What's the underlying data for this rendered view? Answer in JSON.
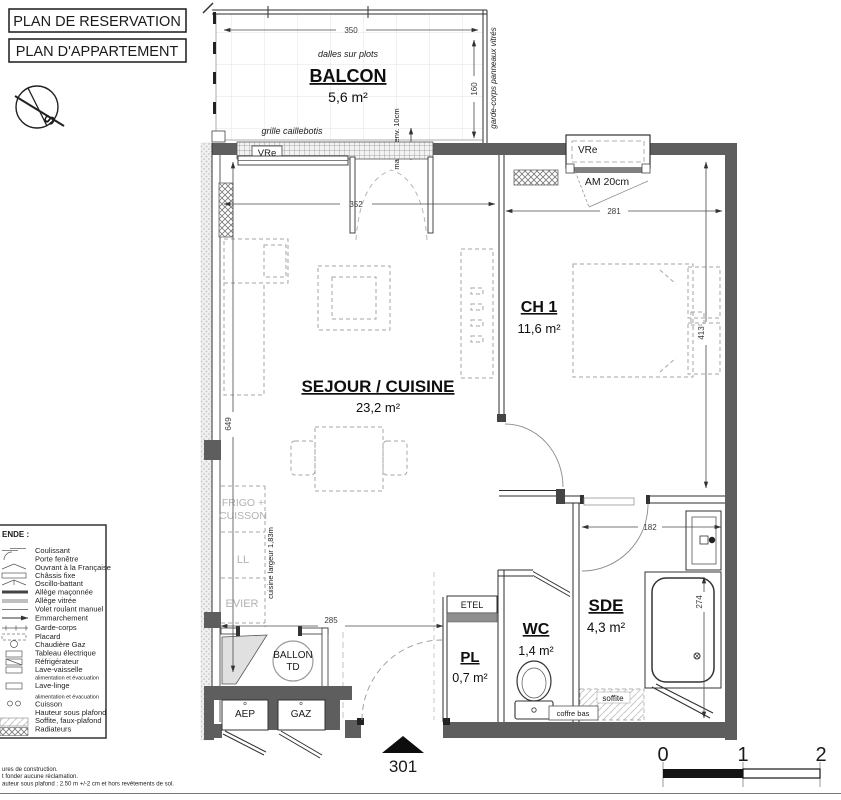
{
  "header": {
    "line1": "PLAN DE RESERVATION",
    "line2": "PLAN D'APPARTEMENT",
    "compass": "S"
  },
  "balcony": {
    "label": "BALCON",
    "area": "5,6 m²",
    "floor_note": "dalles sur plots",
    "grille_note": "grille caillebotis",
    "railing_note": "garde-corps panneaux vitrés",
    "step_note": "marche env. 10cm",
    "window": "VRe"
  },
  "rooms": {
    "sejour": {
      "label": "SEJOUR / CUISINE",
      "area": "23,2 m²"
    },
    "ch1": {
      "label": "CH 1",
      "area": "11,6 m²"
    },
    "wc": {
      "label": "WC",
      "area": "1,4 m²"
    },
    "pl": {
      "label": "PL",
      "area": "0,7 m²"
    },
    "sde": {
      "label": "SDE",
      "area": "4,3 m²"
    }
  },
  "labels": {
    "vre_ch1": "VRe",
    "am": "AM 20cm",
    "etel": "ETEL",
    "ballon_line1": "BALLON",
    "ballon_line2": "TD",
    "aep": "AEP",
    "gaz": "GAZ",
    "frigo_line1": "FRIGO +",
    "frigo_line2": "CUISSON",
    "ll": "LL",
    "evier": "EVIER",
    "kitchen_width": "cuisine largeur 1,83m",
    "soffite": "soffite",
    "coffre": "coffre bas",
    "unit_number": "301"
  },
  "dimensions": {
    "balcony_w": "350",
    "balcony_d": "160",
    "sejour_w": "352",
    "ch1_w": "281",
    "sejour_h": "649",
    "ch1_h": "413",
    "hall_w": "285",
    "sde_w": "182",
    "sde_h": "274"
  },
  "legend": {
    "title": "ENDE :",
    "items": [
      {
        "label": "Coulissant"
      },
      {
        "label": "Porte fenêtre"
      },
      {
        "label": "Ouvrant à la Française"
      },
      {
        "label": "Châssis fixe"
      },
      {
        "label": "Oscillo-battant"
      },
      {
        "label": "Allège maçonnée"
      },
      {
        "label": "Allège vitrée"
      },
      {
        "label": "Volet roulant manuel"
      },
      {
        "label": "Emmarchement"
      },
      {
        "label": "Garde-corps"
      },
      {
        "label": "Placard"
      },
      {
        "label": "Chaudière Gaz"
      },
      {
        "label": "Tableau électrique"
      },
      {
        "label": "Réfrigérateur"
      },
      {
        "label": "Lave-vaisselle"
      },
      {
        "label": "alimentation et évacuation"
      },
      {
        "label": "Lave-linge"
      },
      {
        "label": "alimentation et évacuation"
      },
      {
        "label": "Cuisson"
      },
      {
        "label": "Hauteur sous plafond"
      },
      {
        "label": "Soffite, faux-plafond"
      },
      {
        "label": "Radiateurs"
      }
    ]
  },
  "scale_bar": {
    "t0": "0",
    "t1": "1",
    "t2": "2"
  },
  "footnotes": {
    "line1": "ures de construction.",
    "line2": "t fonder aucune réclamation.",
    "line3": "auteur sous plafond : 2.50 m +/-2 cm et hors revêtements de sol."
  },
  "colors": {
    "wall": "#5e5e5e",
    "dashed_furniture": "#a6a6a6",
    "dim_text": "#3a3a3a",
    "gray_text": "#b2b2b2",
    "accent": "#111111"
  }
}
